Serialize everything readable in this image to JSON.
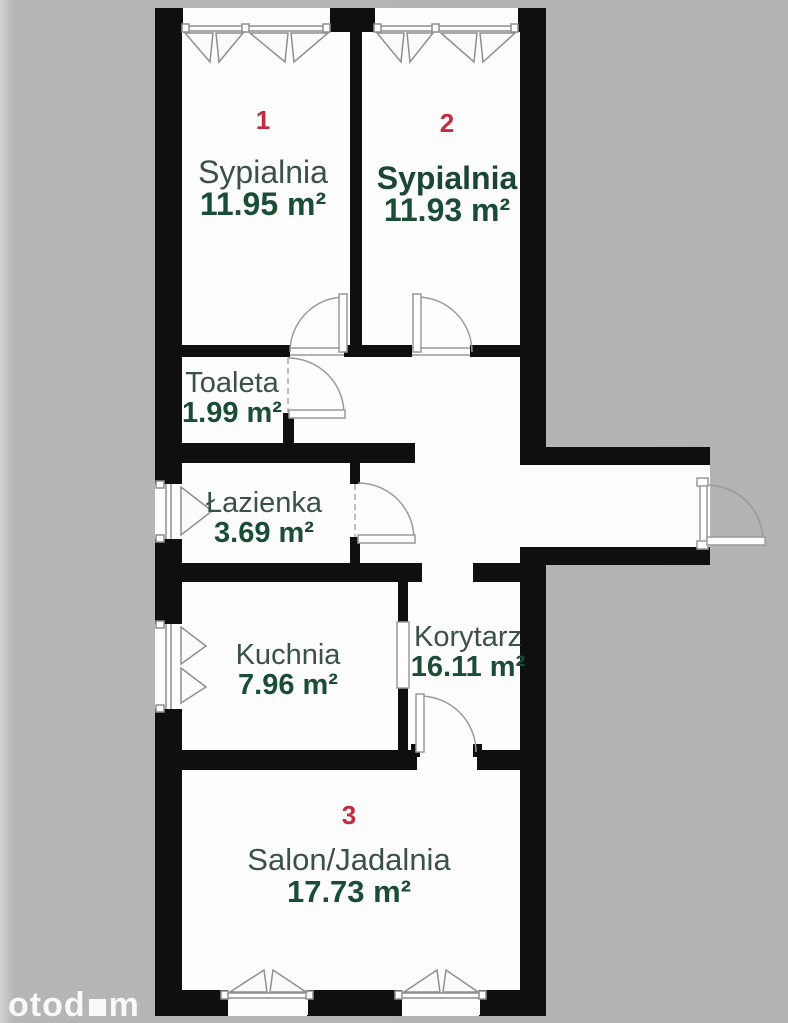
{
  "plan": {
    "type": "apartment-floor-plan",
    "rooms": [
      {
        "number": "1",
        "name": "Sypialnia",
        "area": "11.95 m²"
      },
      {
        "number": "2",
        "name": "Sypialnia",
        "area": "11.93 m²"
      },
      {
        "number": "",
        "name": "Toaleta",
        "area": "1.99 m²"
      },
      {
        "number": "",
        "name": "Łazienka",
        "area": "3.69 m²"
      },
      {
        "number": "",
        "name": "Kuchnia",
        "area": "7.96 m²"
      },
      {
        "number": "",
        "name": "Korytarz",
        "area": "16.11 m²"
      },
      {
        "number": "3",
        "name": "Salon/Jadalnia",
        "area": "17.73 m²"
      }
    ]
  },
  "watermark": {
    "brand_full": "otodom",
    "prefix": "otod",
    "suffix": "m"
  },
  "colors": {
    "background": "#b3b3b3",
    "wall": "#0f0f0f",
    "room_fill": "#fdfdfd",
    "room_name_text": "#3a5147",
    "room_area_text": "#1b4d36",
    "room_number_text": "#c22b3d",
    "symbol_lines": "#8f8f8f",
    "watermark_text": "#ffffff"
  }
}
